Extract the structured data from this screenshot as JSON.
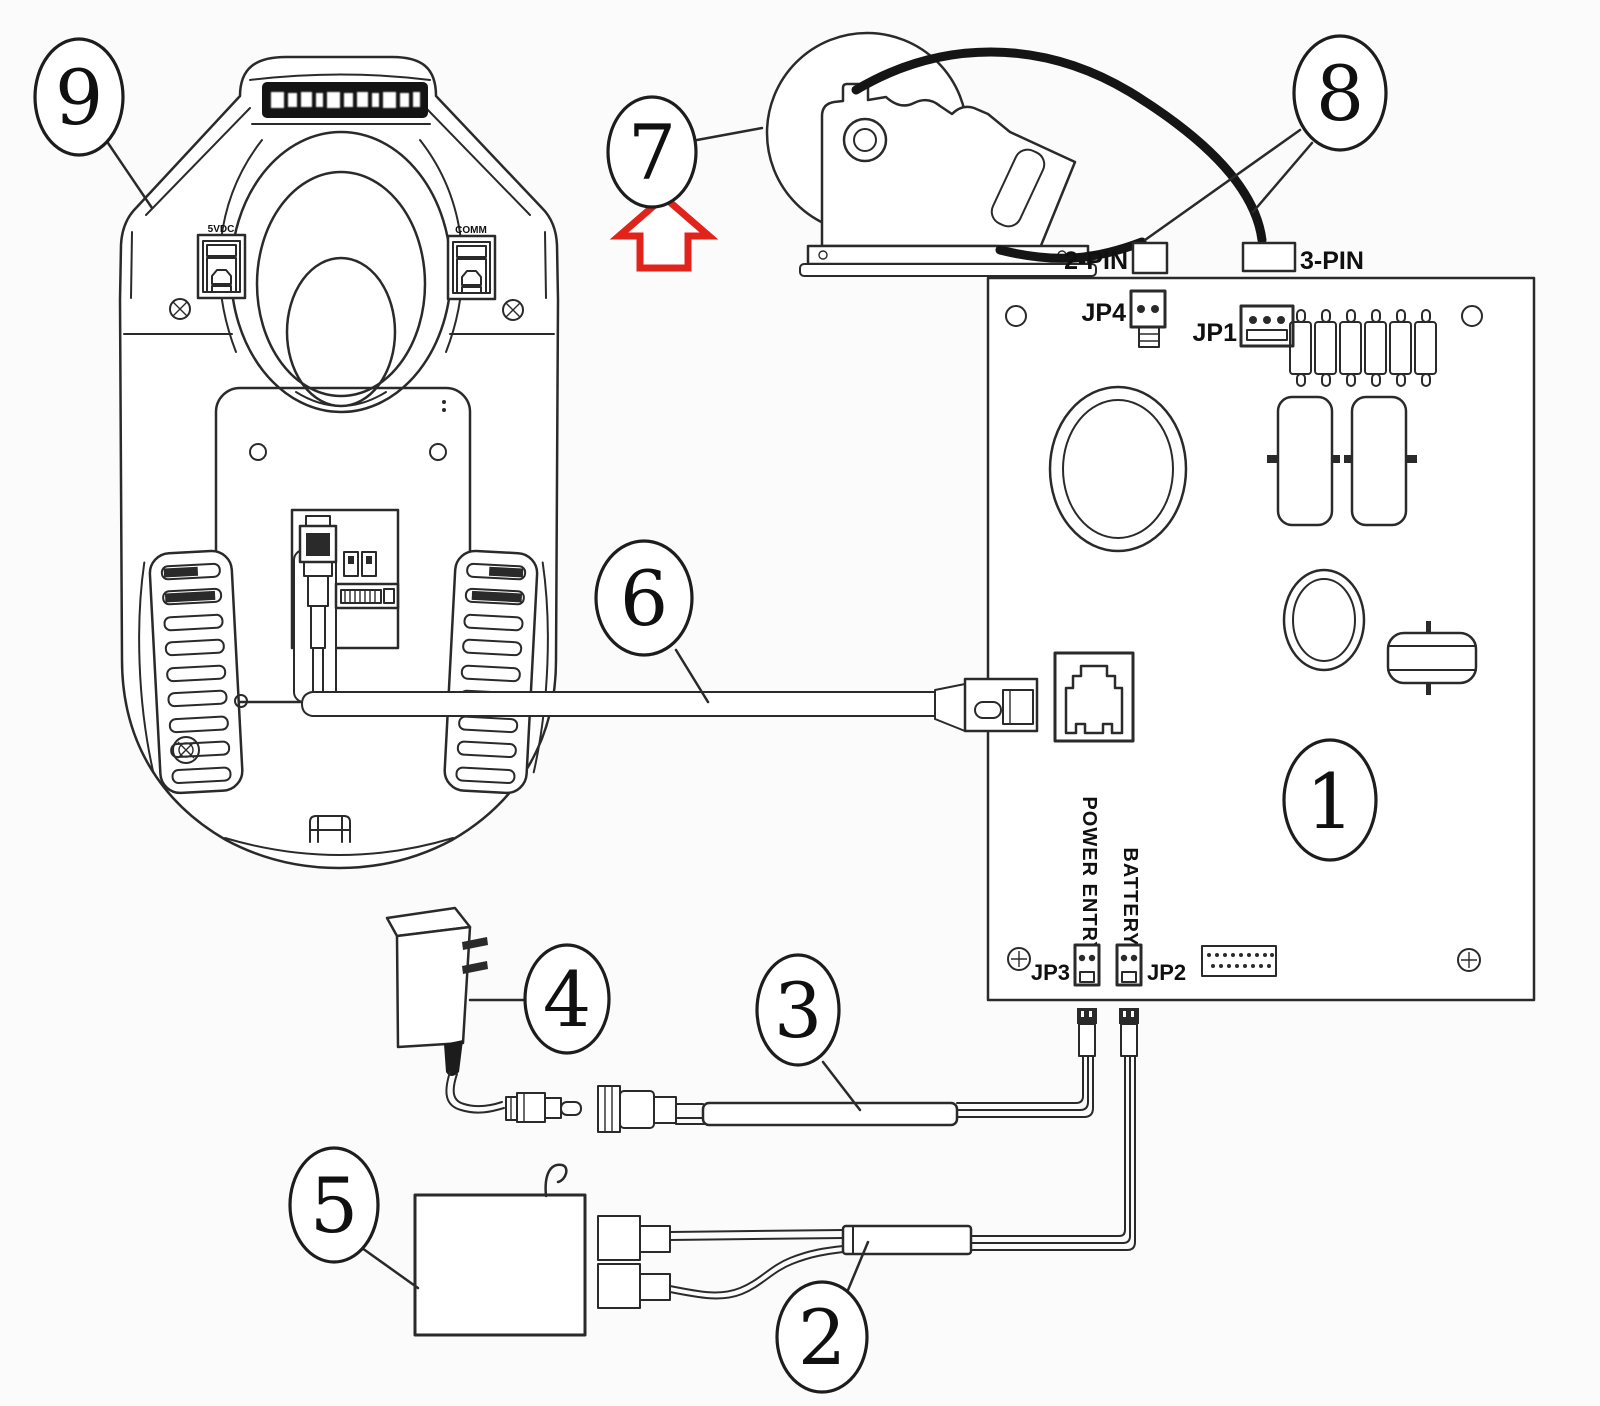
{
  "colors": {
    "line": "#2a2a2a",
    "background": "#fbfbfb",
    "arrow_red": "#e0231b",
    "logo_band": "#141414"
  },
  "callouts": {
    "board": "1",
    "battery_cable": "2",
    "power_cable": "3",
    "adapter": "4",
    "battery": "5",
    "interface_cable": "6",
    "scan_module": "7",
    "module_cables": "8",
    "cradle": "9"
  },
  "board_labels": {
    "jp1": "JP1",
    "jp2": "JP2",
    "jp3": "JP3",
    "jp4": "JP4",
    "power_entry": "POWER ENTRY",
    "battery": "BATTERY"
  },
  "cable_labels": {
    "two_pin": "2-PIN",
    "three_pin": "3-PIN"
  },
  "cradle_labels": {
    "power_port": "5VDC",
    "comm_port": "COMM"
  }
}
